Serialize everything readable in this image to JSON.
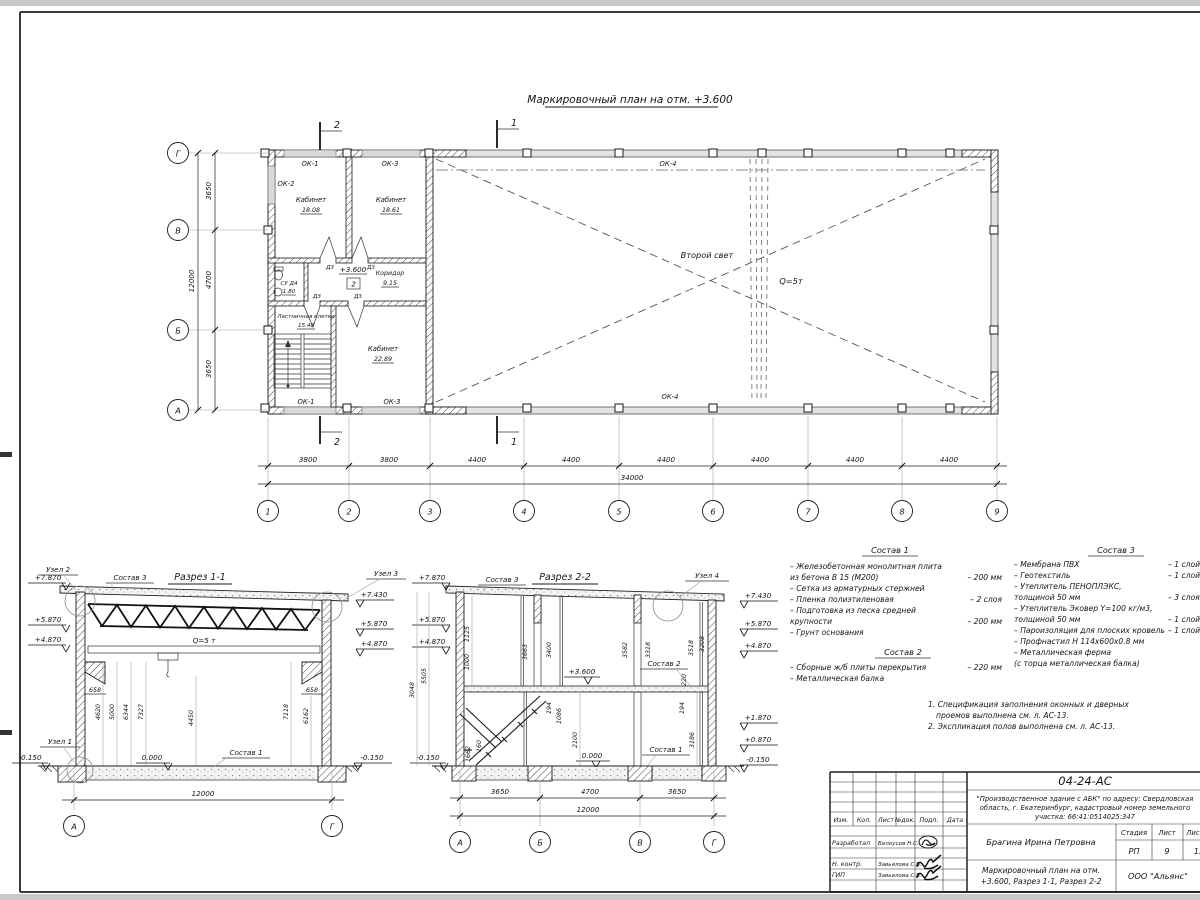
{
  "titles": {
    "plan": "Маркировочный план на отм. +3.600",
    "section1": "Разрез 1-1",
    "section2": "Разрез 2-2"
  },
  "plan": {
    "room1_name": "Кабинет",
    "room1_area": "18.08",
    "room2_name": "Кабинет",
    "room2_area": "18.61",
    "corridor_name": "Коридор",
    "corridor_area": "9.15",
    "wc_name": "СУ Д4",
    "wc_area": "1.80",
    "stair_name": "Лестничная клетка",
    "stair_area": "15.48",
    "room3_name": "Кабинет",
    "room3_area": "22.89",
    "ok1": "ОК-1",
    "ok2": "ОК-2",
    "ok3": "ОК-3",
    "ok4": "ОК-4",
    "door": "Д3",
    "level": "+3.600",
    "storey": "2",
    "second_light": "Второй свет",
    "crane": "Q=5т",
    "mark1": "1",
    "mark2": "2"
  },
  "dims": {
    "h_segments": [
      "3800",
      "3800",
      "4400",
      "4400",
      "4400",
      "4400",
      "4400",
      "4400"
    ],
    "h_total": "34000",
    "axes_h": [
      "1",
      "2",
      "3",
      "4",
      "5",
      "6",
      "7",
      "8",
      "9"
    ],
    "v_segments": [
      "3650",
      "4700",
      "3650"
    ],
    "v_total": "12000",
    "axes_v": [
      "Г",
      "В",
      "Б",
      "А"
    ]
  },
  "s1": {
    "node1": "Узел 1",
    "node2": "Узел 2",
    "node3": "Узел 3",
    "lvl_l1": "+7.870",
    "lvl_l2": "+5.870",
    "lvl_l3": "+4.870",
    "lvl_r1": "+7.430",
    "lvl_r2": "+5.870",
    "lvl_r3": "+4.870",
    "zero": "0.000",
    "minus": "-0.150",
    "crane": "Q=5 т",
    "sostav3_ref": "Состав 3",
    "sostav1_ref": "Состав 1",
    "corbel": "658",
    "d1": "4620",
    "d2": "5000",
    "d3": "6344",
    "d4": "7327",
    "d5": "4450",
    "d6": "7118",
    "d7": "6162",
    "total": "12000",
    "axis_a": "А",
    "axis_g": "Г"
  },
  "s2": {
    "node4": "Узел 4",
    "lvl_l1": "+7.870",
    "lvl_l2": "+5.870",
    "lvl_l3": "+4.870",
    "lvl_r1": "+7.430",
    "lvl_r2": "+5.870",
    "lvl_r3": "+4.870",
    "lvl_r4": "+1.870",
    "lvl_r5": "+0.870",
    "zero": "0.000",
    "minus": "-0.150",
    "level36": "+3.600",
    "sostav3_ref": "Состав 3",
    "sostav2_ref": "Состав 2",
    "sostav1_ref": "Состав 1",
    "d3048": "3048",
    "d5505": "5505",
    "d1125": "1125",
    "d1000": "1000",
    "d3663": "3663",
    "d3400": "3400",
    "d3582": "3582",
    "d3318": "3318",
    "d3518": "3518",
    "d3208": "3208",
    "d220": "220",
    "d194a": "194",
    "d1086": "1086",
    "d194b": "194",
    "d3186": "3186",
    "d1662": "1662",
    "d160": "160",
    "d2100": "2100",
    "b1": "3650",
    "b2": "4700",
    "b3": "3650",
    "total": "12000",
    "axes": [
      "А",
      "Б",
      "В",
      "Г"
    ]
  },
  "sostav1": {
    "title": "Состав 1",
    "lines": [
      {
        "t": "– Железобетонная  монолитная плита",
        "v": ""
      },
      {
        "t": "   из бетона В 15 (М200)",
        "v": "–  200 мм"
      },
      {
        "t": "– Сетка из арматурных стержней",
        "v": ""
      },
      {
        "t": "– Пленка полиэтиленовая",
        "v": "–  2 слоя"
      },
      {
        "t": "– Подготовка из песка средней",
        "v": ""
      },
      {
        "t": "   крупности",
        "v": "–  200 мм"
      },
      {
        "t": "– Грунт основания",
        "v": ""
      }
    ]
  },
  "sostav2": {
    "title": "Состав 2",
    "lines": [
      {
        "t": "– Сборные ж/б плиты перекрытия",
        "v": "–  220 мм"
      },
      {
        "t": "– Металлическая балка",
        "v": ""
      }
    ]
  },
  "sostav3": {
    "title": "Состав 3",
    "lines": [
      {
        "t": "– Мембрана ПВХ",
        "v": "– 1 слой"
      },
      {
        "t": "– Геотекстиль",
        "v": "– 1 слой"
      },
      {
        "t": "– Утеплитель ПЕНОПЛЭКС,",
        "v": ""
      },
      {
        "t": "   толщиной 50 мм",
        "v": "– 3 слоя"
      },
      {
        "t": "– Утеплитель Эковер Y=100 кг/м3,",
        "v": ""
      },
      {
        "t": "   толщиной 50 мм",
        "v": "– 1 слой"
      },
      {
        "t": "– Пароизоляция для плоских кровель",
        "v": "– 1 слой"
      },
      {
        "t": "– Профнастил Н 114х600х0.8 мм",
        "v": ""
      },
      {
        "t": "– Металлическая ферма",
        "v": ""
      },
      {
        "t": "   (с торца металлическая балка)",
        "v": ""
      }
    ]
  },
  "notes": {
    "line1": "1. Спецификация заполнения оконных и дверных",
    "line2": "проемов выполнена см. л. АС-13.",
    "line3": "2. Экспликация полов выполнена см. л. АС-13."
  },
  "titleblock": {
    "doc_number": "04-24-АС",
    "project_line1": "\"Производственное здание с АБК\" по адресу: Свердловская",
    "project_line2": "область, г. Екатеринбург, кадастровый номер земельного",
    "project_line3": "участка: 66:41:0514025:347",
    "col_izm": "Изм.",
    "col_kol": "Кол.",
    "col_list": "Лист",
    "col_ndok": "№док.",
    "col_podp": "Подп.",
    "col_data": "Дата",
    "row1_role": "Разработал",
    "row1_name": "Белоусов Н.С.",
    "row2_role": "Н. контр.",
    "row2_name": "Завьялова С.В.",
    "row3_role": "ГИП",
    "row3_name": "Завьялова С.В.",
    "engineer": "Брагина Ирина Петровна",
    "stage_label": "Стадия",
    "list_label": "Лист",
    "listov_label": "Листов",
    "stage": "РП",
    "list_no": "9",
    "listov": "13",
    "title_line1": "Маркировочный план на отм.",
    "title_line2": "+3.600, Разрез 1-1, Разрез 2-2",
    "company": "ООО \"Альянс\""
  }
}
